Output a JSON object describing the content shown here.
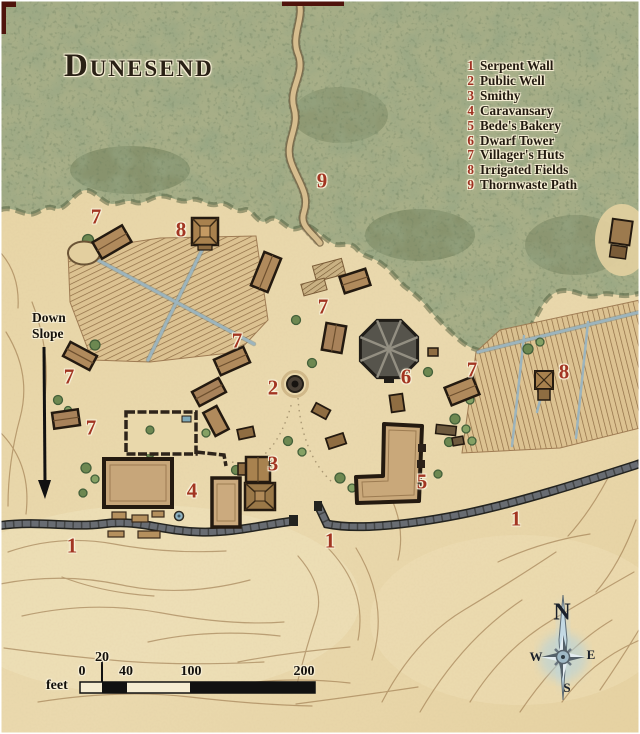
{
  "map_title": "Dunesend",
  "legend": {
    "items": [
      {
        "num": "1",
        "label": "Serpent Wall"
      },
      {
        "num": "2",
        "label": "Public Well"
      },
      {
        "num": "3",
        "label": "Smithy"
      },
      {
        "num": "4",
        "label": "Caravansary"
      },
      {
        "num": "5",
        "label": "Bede's Bakery"
      },
      {
        "num": "6",
        "label": "Dwarf Tower"
      },
      {
        "num": "7",
        "label": "Villager's Huts"
      },
      {
        "num": "8",
        "label": "Irrigated Fields"
      },
      {
        "num": "9",
        "label": "Thornwaste Path"
      }
    ]
  },
  "map_labels": [
    {
      "text": "9",
      "feature": "Thornwaste Path"
    },
    {
      "text": "7",
      "feature": "Villager's Huts"
    },
    {
      "text": "8",
      "feature": "Irrigated Fields"
    },
    {
      "text": "7",
      "feature": "Villager's Huts"
    },
    {
      "text": "7",
      "feature": "Villager's Huts"
    },
    {
      "text": "2",
      "feature": "Public Well"
    },
    {
      "text": "6",
      "feature": "Dwarf Tower"
    },
    {
      "text": "7",
      "feature": "Villager's Huts"
    },
    {
      "text": "8",
      "feature": "Irrigated Fields"
    },
    {
      "text": "7",
      "feature": "Villager's Huts"
    },
    {
      "text": "7",
      "feature": "Villager's Huts"
    },
    {
      "text": "3",
      "feature": "Smithy"
    },
    {
      "text": "4",
      "feature": "Caravansary"
    },
    {
      "text": "5",
      "feature": "Bede's Bakery"
    },
    {
      "text": "1",
      "feature": "Serpent Wall"
    },
    {
      "text": "1",
      "feature": "Serpent Wall"
    },
    {
      "text": "1",
      "feature": "Serpent Wall"
    }
  ],
  "annotations": {
    "down_slope_line1": "Down",
    "down_slope_line2": "Slope"
  },
  "scale_bar": {
    "unit": "feet",
    "tick0": "0",
    "tick20": "20",
    "tick40": "40",
    "tick100": "100",
    "tick200": "200"
  },
  "compass": {
    "n": "N",
    "e": "E",
    "s": "S",
    "w": "W"
  },
  "colors": {
    "sand": "#e9d8ab",
    "scrub_green": "#a7ae87",
    "label_red": "#a23522",
    "wall_grey": "#686c72",
    "roof_tan": "#c7a67a",
    "channel_blue": "#9cb4bd",
    "ink": "#241c12",
    "frame_maroon": "#4f130c"
  }
}
